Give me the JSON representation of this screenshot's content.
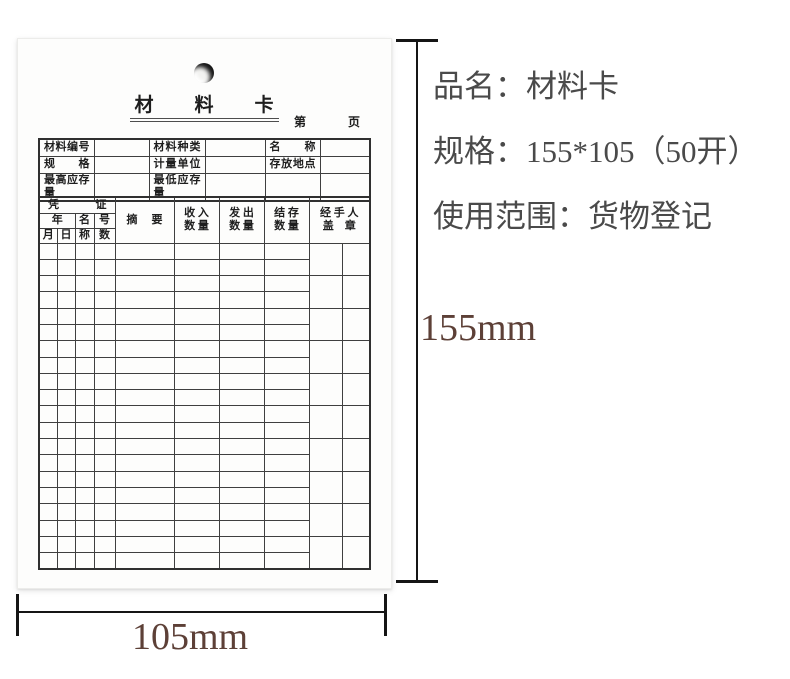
{
  "colors": {
    "ink": "#1e1e1e",
    "grid_line": "#3f3f3f",
    "dimension_text": "#5d4037",
    "dimension_line": "#151515",
    "panel_text": "#4a4a4a"
  },
  "card": {
    "title": "材　　料　　卡",
    "page_prefix": "第",
    "page_suffix": "页",
    "info_rows": [
      [
        "材料编号",
        "",
        "材料种类",
        "",
        "名称",
        ""
      ],
      [
        "规格",
        "",
        "计量单位",
        "",
        "存放地点",
        ""
      ],
      [
        "最高应存量",
        "",
        "最低应存量",
        "",
        "",
        ""
      ]
    ],
    "ledger": {
      "voucher_group": "凭 证",
      "year": "年",
      "month": "月",
      "day": "日",
      "name_top": "名",
      "name_bottom": "称",
      "number_top": "号",
      "number_bottom": "数",
      "summary": "摘 要",
      "in_qty": "收 入\n数 量",
      "out_qty": "发 出\n数 量",
      "balance_qty": "结 存\n数 量",
      "handler": "经 手 人\n盖　章",
      "body_rows": 20
    }
  },
  "annotations": {
    "height_label": "155mm",
    "width_label": "105mm",
    "product_name": "品名：材料卡",
    "spec": "规格：155*105（50开）",
    "usage": "使用范围：货物登记"
  }
}
